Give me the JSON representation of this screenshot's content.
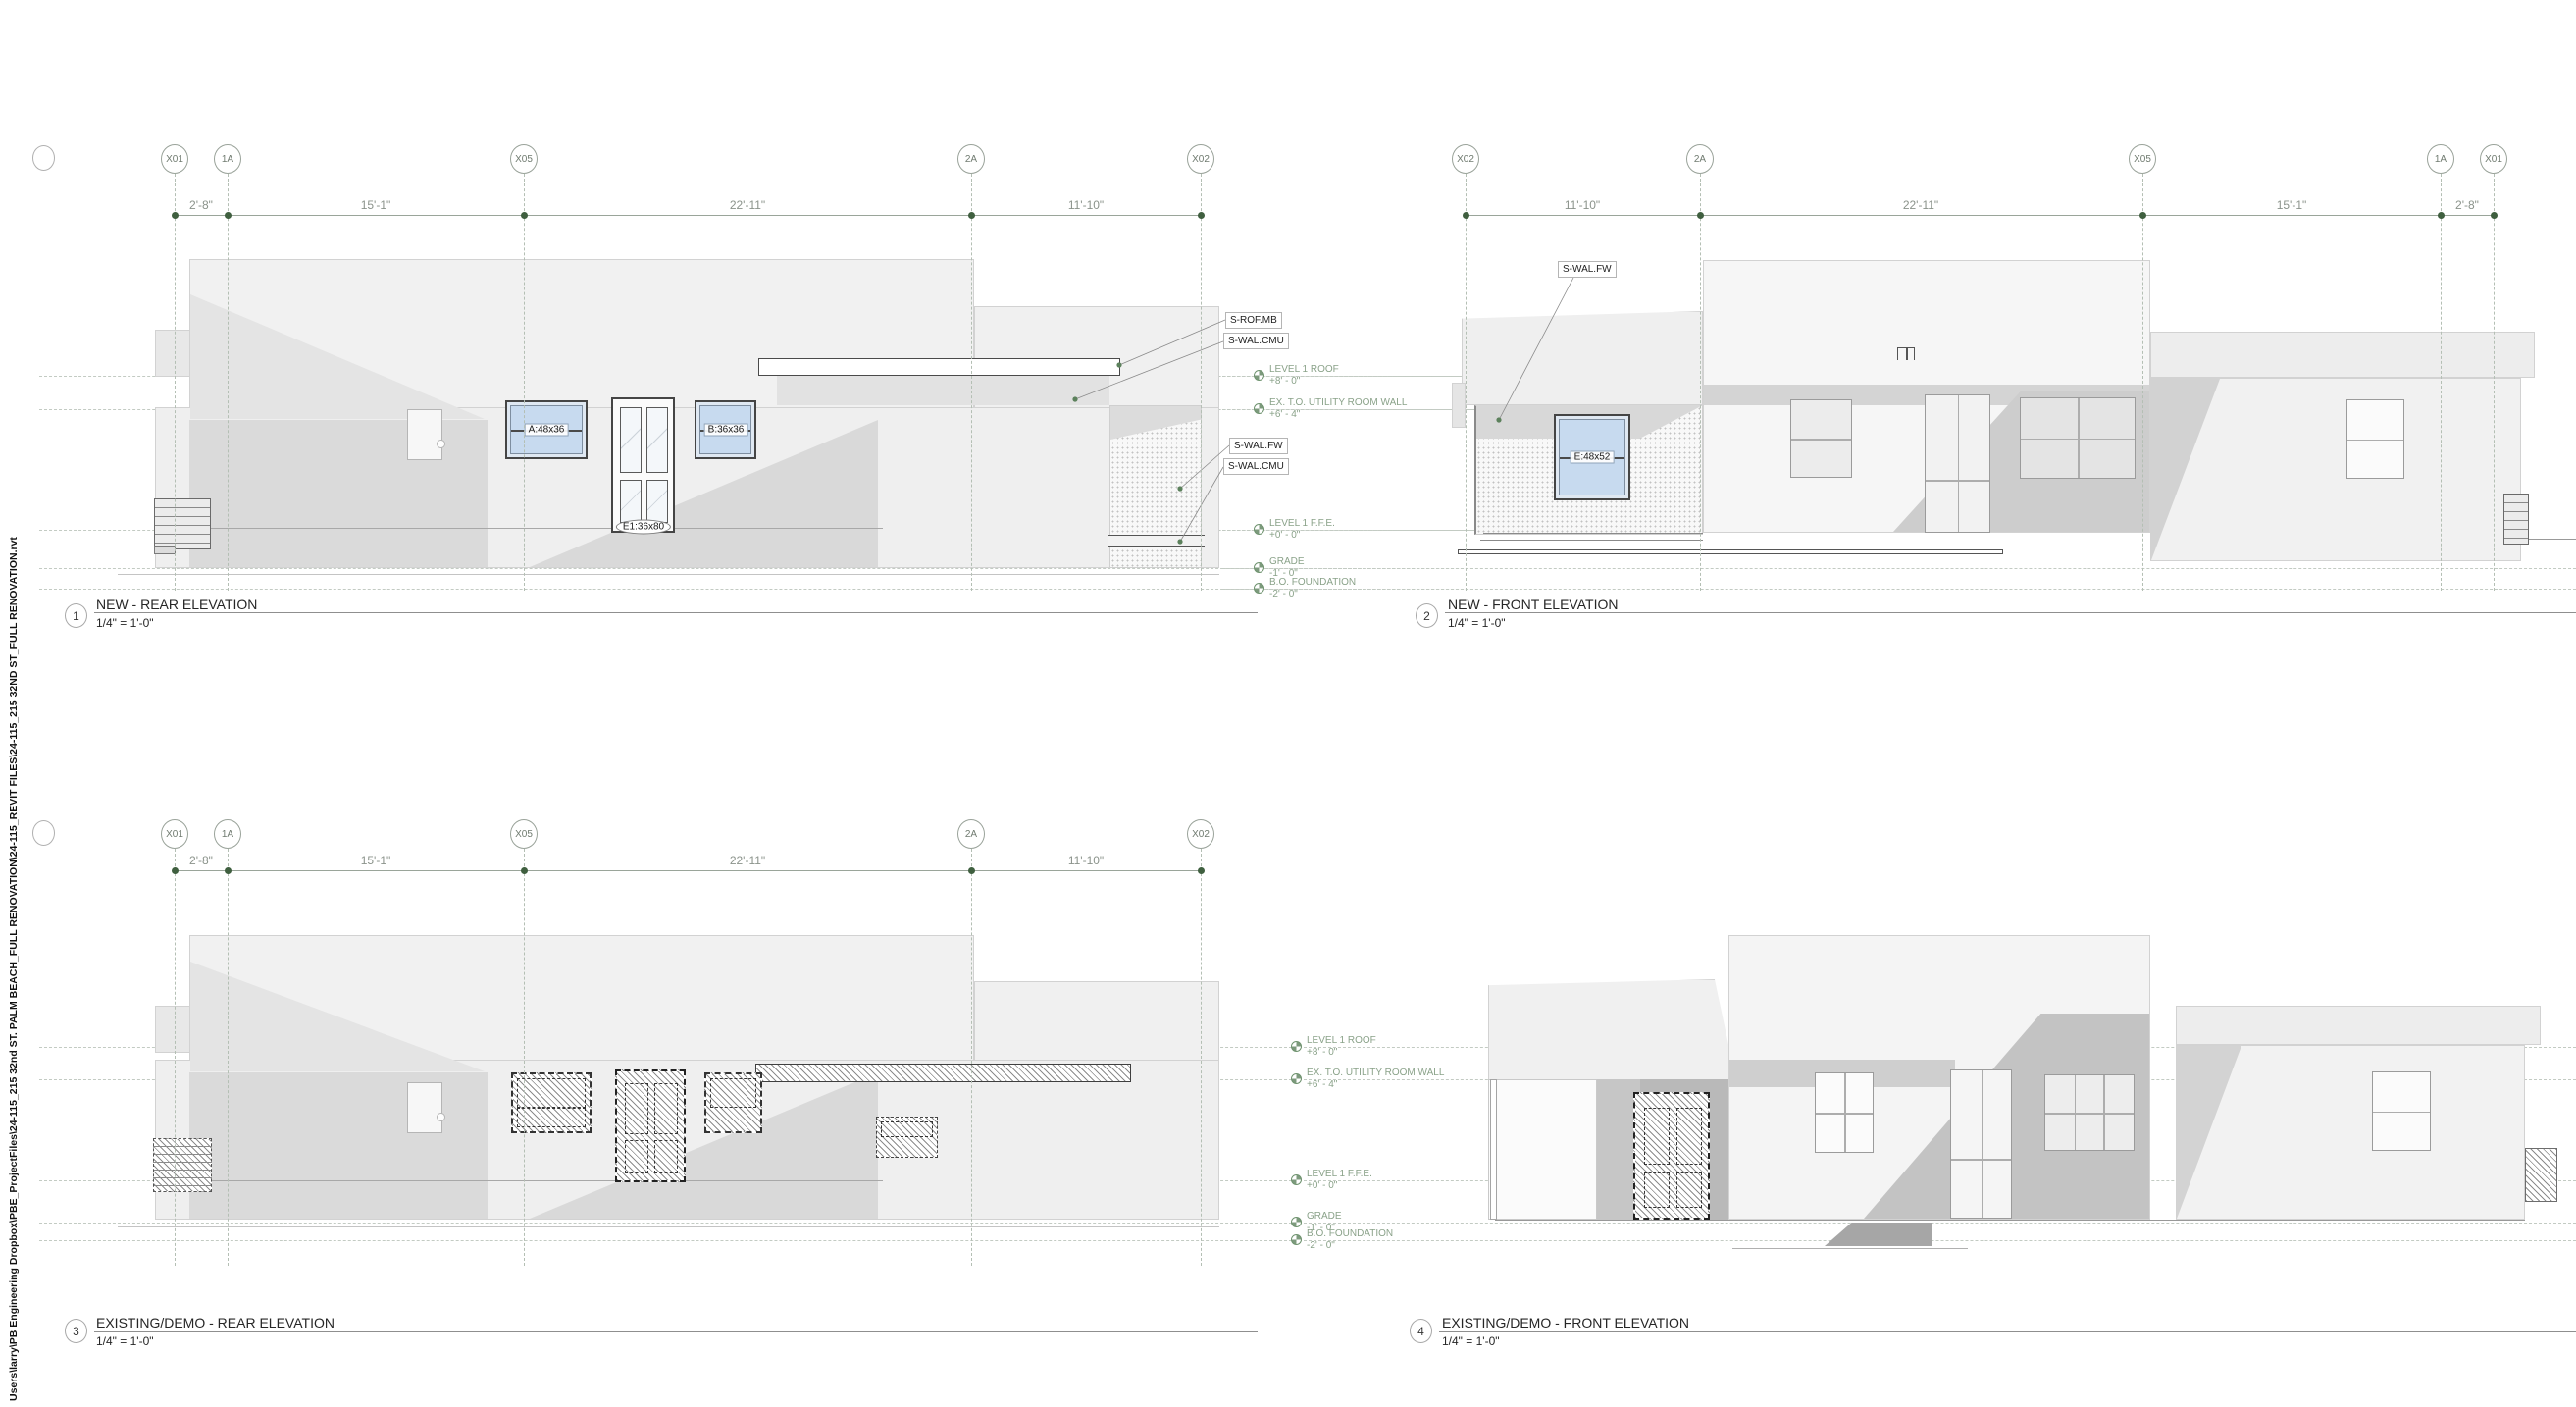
{
  "sheet": {
    "file_path": "Users\\larry\\PB Engineering Dropbox\\PBE_ProjectFiles\\24-115_215 32nd ST. PALM BEACH_FULL RENOVATION\\24-115_REVIT FILES\\24-115_215 32ND ST_FULL RENOVATION.rvt"
  },
  "views": {
    "v1": {
      "number": "1",
      "title": "NEW - REAR ELEVATION",
      "scale": "1/4\" = 1'-0\""
    },
    "v2": {
      "number": "2",
      "title": "NEW - FRONT ELEVATION",
      "scale": "1/4\" = 1'-0\""
    },
    "v3": {
      "number": "3",
      "title": "EXISTING/DEMO - REAR ELEVATION",
      "scale": "1/4\" = 1'-0\""
    },
    "v4": {
      "number": "4",
      "title": "EXISTING/DEMO - FRONT ELEVATION",
      "scale": "1/4\" = 1'-0\""
    }
  },
  "grid": {
    "rear_labels": [
      "X01",
      "1A",
      "X05",
      "2A",
      "X02"
    ],
    "rear_dims": [
      "2'-8\"",
      "15'-1\"",
      "22'-11\"",
      "11'-10\""
    ],
    "front_labels": [
      "X02",
      "2A",
      "X05",
      "1A",
      "X01"
    ],
    "front_dims": [
      "11'-10\"",
      "22'-11\"",
      "15'-1\"",
      "2'-8\""
    ]
  },
  "levels": [
    {
      "name": "LEVEL 1 ROOF",
      "elev": "+8' - 0\""
    },
    {
      "name": "EX. T.O. UTILITY ROOM WALL",
      "elev": "+6' - 4\""
    },
    {
      "name": "LEVEL 1 F.F.E.",
      "elev": "+0' - 0\""
    },
    {
      "name": "GRADE",
      "elev": "-1' - 0\""
    },
    {
      "name": "B.O. FOUNDATION",
      "elev": "-2' - 0\""
    }
  ],
  "keynotes": {
    "rear": [
      "S-ROF.MB",
      "S-WAL.CMU",
      "S-WAL.FW",
      "S-WAL.CMU"
    ],
    "front": "S-WAL.FW"
  },
  "tags": {
    "window_a": "A:48x36",
    "window_b": "B:36x36",
    "door_e1": "E1:36x80",
    "window_e": "E:48x52"
  },
  "colors": {
    "level_green": "#7d9a7d",
    "grid_dot_green": "#3f5f3f",
    "glass_blue": "#c7daef"
  }
}
